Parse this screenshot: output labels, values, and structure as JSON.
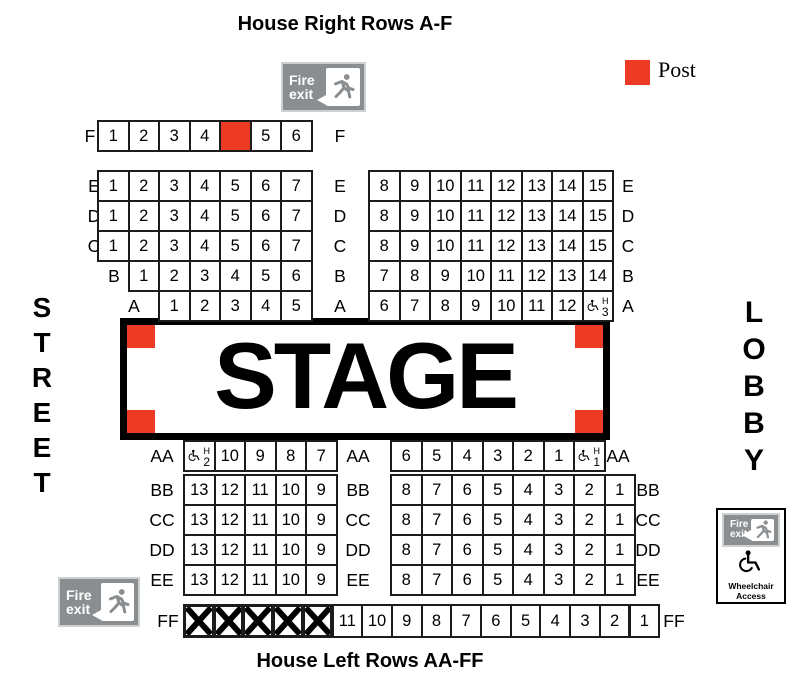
{
  "titles": {
    "top": "House Right Rows A-F",
    "bottom": "House Left Rows AA-FF"
  },
  "legend": {
    "label": "Post"
  },
  "colors": {
    "post_red": "#ED3B23"
  },
  "stage": {
    "label": "STAGE"
  },
  "side_labels": {
    "left": "STREET",
    "right": "LOBBY"
  },
  "fire_exit_sign": {
    "line1": "Fire",
    "line2": "exit"
  },
  "wheelchair_access": {
    "line1": "Wheelchair",
    "line2": "Access"
  },
  "wheelchair_seat_tag": "H",
  "rows": [
    {
      "id": "F",
      "left_label": "F",
      "center_label": "F",
      "right_label": "",
      "left": [
        "1",
        "2",
        "3",
        "4",
        {
          "t": "post"
        },
        "5",
        "6"
      ],
      "right": []
    },
    {
      "id": "E",
      "left_label": "E",
      "center_label": "E",
      "right_label": "E",
      "left": [
        "1",
        "2",
        "3",
        "4",
        "5",
        "6",
        "7"
      ],
      "right": [
        "8",
        "9",
        "10",
        "11",
        "12",
        "13",
        "14",
        "15"
      ]
    },
    {
      "id": "D",
      "left_label": "D",
      "center_label": "D",
      "right_label": "D",
      "left": [
        "1",
        "2",
        "3",
        "4",
        "5",
        "6",
        "7"
      ],
      "right": [
        "8",
        "9",
        "10",
        "11",
        "12",
        "13",
        "14",
        "15"
      ]
    },
    {
      "id": "C",
      "left_label": "C",
      "center_label": "C",
      "right_label": "C",
      "left": [
        "1",
        "2",
        "3",
        "4",
        "5",
        "6",
        "7"
      ],
      "right": [
        "8",
        "9",
        "10",
        "11",
        "12",
        "13",
        "14",
        "15"
      ]
    },
    {
      "id": "B",
      "left_label": "B",
      "center_label": "B",
      "right_label": "B",
      "left": [
        "1",
        "2",
        "3",
        "4",
        "5",
        "6"
      ],
      "right": [
        "7",
        "8",
        "9",
        "10",
        "11",
        "12",
        "13",
        "14"
      ]
    },
    {
      "id": "A",
      "left_label": "A",
      "center_label": "A",
      "right_label": "A",
      "left": [
        "1",
        "2",
        "3",
        "4",
        "5"
      ],
      "right": [
        "6",
        "7",
        "8",
        "9",
        "10",
        "11",
        "12",
        {
          "t": "wc",
          "n": "3"
        }
      ]
    },
    {
      "id": "AA",
      "left_label": "AA",
      "center_label": "AA",
      "right_label": "AA",
      "left": [
        {
          "t": "wc",
          "n": "2"
        },
        "10",
        "9",
        "8",
        "7"
      ],
      "right": [
        "6",
        "5",
        "4",
        "3",
        "2",
        "1",
        {
          "t": "wc",
          "n": "1"
        }
      ]
    },
    {
      "id": "BB",
      "left_label": "BB",
      "center_label": "BB",
      "right_label": "BB",
      "left": [
        "13",
        "12",
        "11",
        "10",
        "9"
      ],
      "right": [
        "8",
        "7",
        "6",
        "5",
        "4",
        "3",
        "2",
        "1"
      ]
    },
    {
      "id": "CC",
      "left_label": "CC",
      "center_label": "CC",
      "right_label": "CC",
      "left": [
        "13",
        "12",
        "11",
        "10",
        "9"
      ],
      "right": [
        "8",
        "7",
        "6",
        "5",
        "4",
        "3",
        "2",
        "1"
      ]
    },
    {
      "id": "DD",
      "left_label": "DD",
      "center_label": "DD",
      "right_label": "DD",
      "left": [
        "13",
        "12",
        "11",
        "10",
        "9"
      ],
      "right": [
        "8",
        "7",
        "6",
        "5",
        "4",
        "3",
        "2",
        "1"
      ]
    },
    {
      "id": "EE",
      "left_label": "EE",
      "center_label": "EE",
      "right_label": "EE",
      "left": [
        "13",
        "12",
        "11",
        "10",
        "9"
      ],
      "right": [
        "8",
        "7",
        "6",
        "5",
        "4",
        "3",
        "2",
        "1"
      ]
    },
    {
      "id": "FF",
      "left_label": "FF",
      "center_label": "",
      "right_label": "FF",
      "left": [
        {
          "t": "x"
        },
        {
          "t": "x"
        },
        {
          "t": "x"
        },
        {
          "t": "x"
        },
        {
          "t": "x"
        }
      ],
      "right": [
        "11",
        "10",
        "9",
        "8",
        "7",
        "6",
        "5",
        "4",
        "3",
        "2",
        "1"
      ]
    }
  ]
}
